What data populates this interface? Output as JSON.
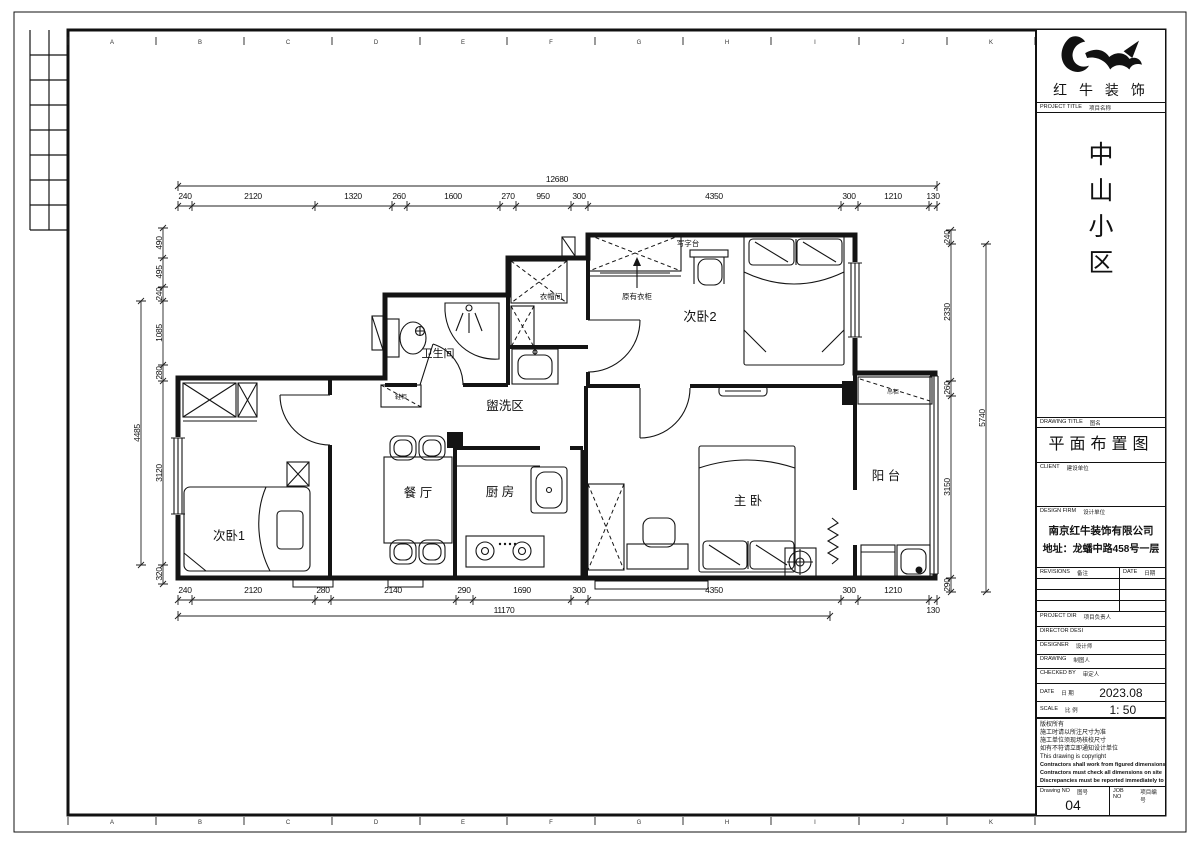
{
  "sheet": {
    "grid_letters": [
      "A",
      "B",
      "C",
      "D",
      "E",
      "F",
      "G",
      "H",
      "I",
      "J",
      "K"
    ]
  },
  "logo": {
    "company": "红 牛 装 饰"
  },
  "title_block": {
    "project_title_label_en": "PROJECT TITLE",
    "project_title_label_cn": "项目名称",
    "project_name_chars": [
      "中",
      "山",
      "小",
      "区"
    ],
    "drawing_title_label_en": "DRAWING TITLE",
    "drawing_title_label_cn": "图名",
    "drawing_title": "平面布置图",
    "client_label_en": "CLIENT",
    "client_label_cn": "建设单位",
    "design_firm_label_en": "DESIGN FIRM",
    "design_firm_label_cn": "设计单位",
    "design_firm_name": "南京红牛装饰有限公司",
    "design_firm_address": "地址：龙蟠中路458号一层",
    "revisions_label_en": "REVISIONS",
    "revisions_label_cn": "备注",
    "date_col_label_en": "DATE",
    "date_col_label_cn": "日期",
    "project_dir_en": "PROJECT DIR",
    "project_dir_cn": "项目负责人",
    "director_en": "DIRECTOR DESI",
    "designer_en": "DESIGNER",
    "designer_cn": "设计师",
    "drawing_by_en": "DRAWING",
    "drawing_by_cn": "制图人",
    "checked_by_en": "CHECKED BY",
    "checked_by_cn": "审定人",
    "date_en": "DATE",
    "date_cn": "日 期",
    "date_value": "2023.08",
    "scale_en": "SCALE",
    "scale_cn": "比 例",
    "scale_value": "1: 50",
    "notes": [
      "版权所有",
      "施工时请以所注尺寸为准",
      "施工单位须现场核校尺寸",
      "如有不符请立即通知设计单位",
      "This drawing is copyright",
      "Contractors shall work from figured dimensions only",
      "Contractors must check all dimensions on site",
      "Discrepancies must be reported immediately to architects"
    ],
    "drawing_no_en": "Drawing NO",
    "drawing_no_cn": "图号",
    "drawing_no": "04",
    "job_no_en": "JOB NO",
    "job_no_cn": "项目编号"
  },
  "plan": {
    "rooms": [
      {
        "id": "bedroom1",
        "label": "次卧1"
      },
      {
        "id": "dining",
        "label": "餐 厅"
      },
      {
        "id": "kitchen",
        "label": "厨 房"
      },
      {
        "id": "wash",
        "label": "盥洗区"
      },
      {
        "id": "bath",
        "label": "卫生间"
      },
      {
        "id": "cloak",
        "label": "衣帽间"
      },
      {
        "id": "bedroom2",
        "label": "次卧2"
      },
      {
        "id": "master",
        "label": "主 卧"
      },
      {
        "id": "balcony",
        "label": "阳 台"
      }
    ],
    "annotations": {
      "desk": "写字台",
      "existing_wardrobe": "原有衣柜",
      "shoe_cabinet": "鞋柜",
      "hanging_cabinet": "吊柜"
    }
  },
  "dims": {
    "top": {
      "overall": "12680",
      "segs": [
        "240",
        "2120",
        "1320",
        "260",
        "1600",
        "270",
        "950",
        "300",
        "4350",
        "300",
        "1210",
        "130"
      ]
    },
    "bottom": {
      "overall": "11170",
      "right_end": "130",
      "segs": [
        "240",
        "2120",
        "280",
        "2140",
        "290",
        "1690",
        "300",
        "4350",
        "300",
        "1210"
      ]
    },
    "left": {
      "overall": "4485",
      "segs": [
        "490",
        "495",
        "240",
        "1085",
        "280",
        "3120",
        "320"
      ]
    },
    "right": {
      "overall": "5740",
      "segs": [
        "240",
        "2330",
        "260",
        "3150",
        "290"
      ]
    }
  }
}
